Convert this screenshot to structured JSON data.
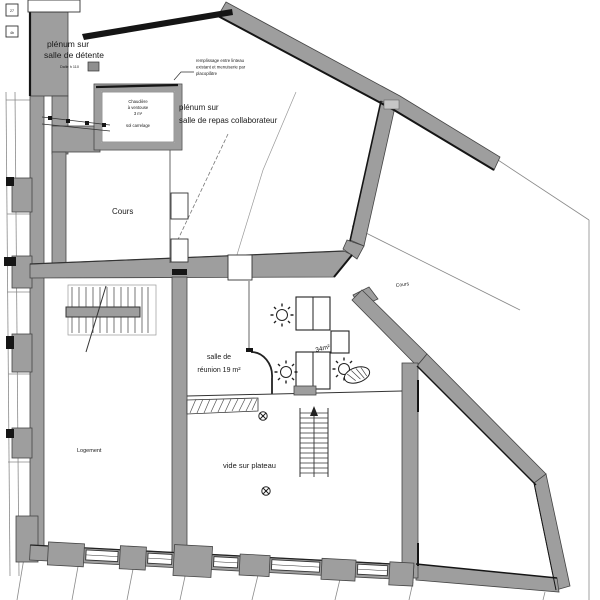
{
  "drawing_type": "architectural floor plan",
  "rooms": {
    "plenum_detente": {
      "line1": "plénum sur",
      "line2": "salle de détente"
    },
    "plenum_repas": {
      "line1": "plénum sur",
      "line2": "salle de repas collaborateur"
    },
    "cours_left": "Cours",
    "cours_right": "Cours",
    "salle_reunion": {
      "line1": "salle de",
      "line2": "réunion 19 m²"
    },
    "area_34": "34m²",
    "vide_plateau": "vide sur plateau",
    "logement": "Logement",
    "chaufferie": {
      "line1": "Chaudière",
      "line2": "à ventouse",
      "line3": "3 m²",
      "line4": "sol carrelage"
    }
  },
  "annotations": {
    "remplissage": {
      "line1": "remplissage entre linteau",
      "line2": "existant et menuiserie par",
      "line3": "placoplâtre"
    },
    "dalle": "Dalle h 110",
    "box1": "27",
    "box2": "4b"
  },
  "colors": {
    "wall_gray": "#9e9e9e",
    "wall_black": "#151515",
    "line_dark": "#444444",
    "text": "#1a1a1a",
    "text_light": "#b3b3b3",
    "background": "#ffffff"
  }
}
